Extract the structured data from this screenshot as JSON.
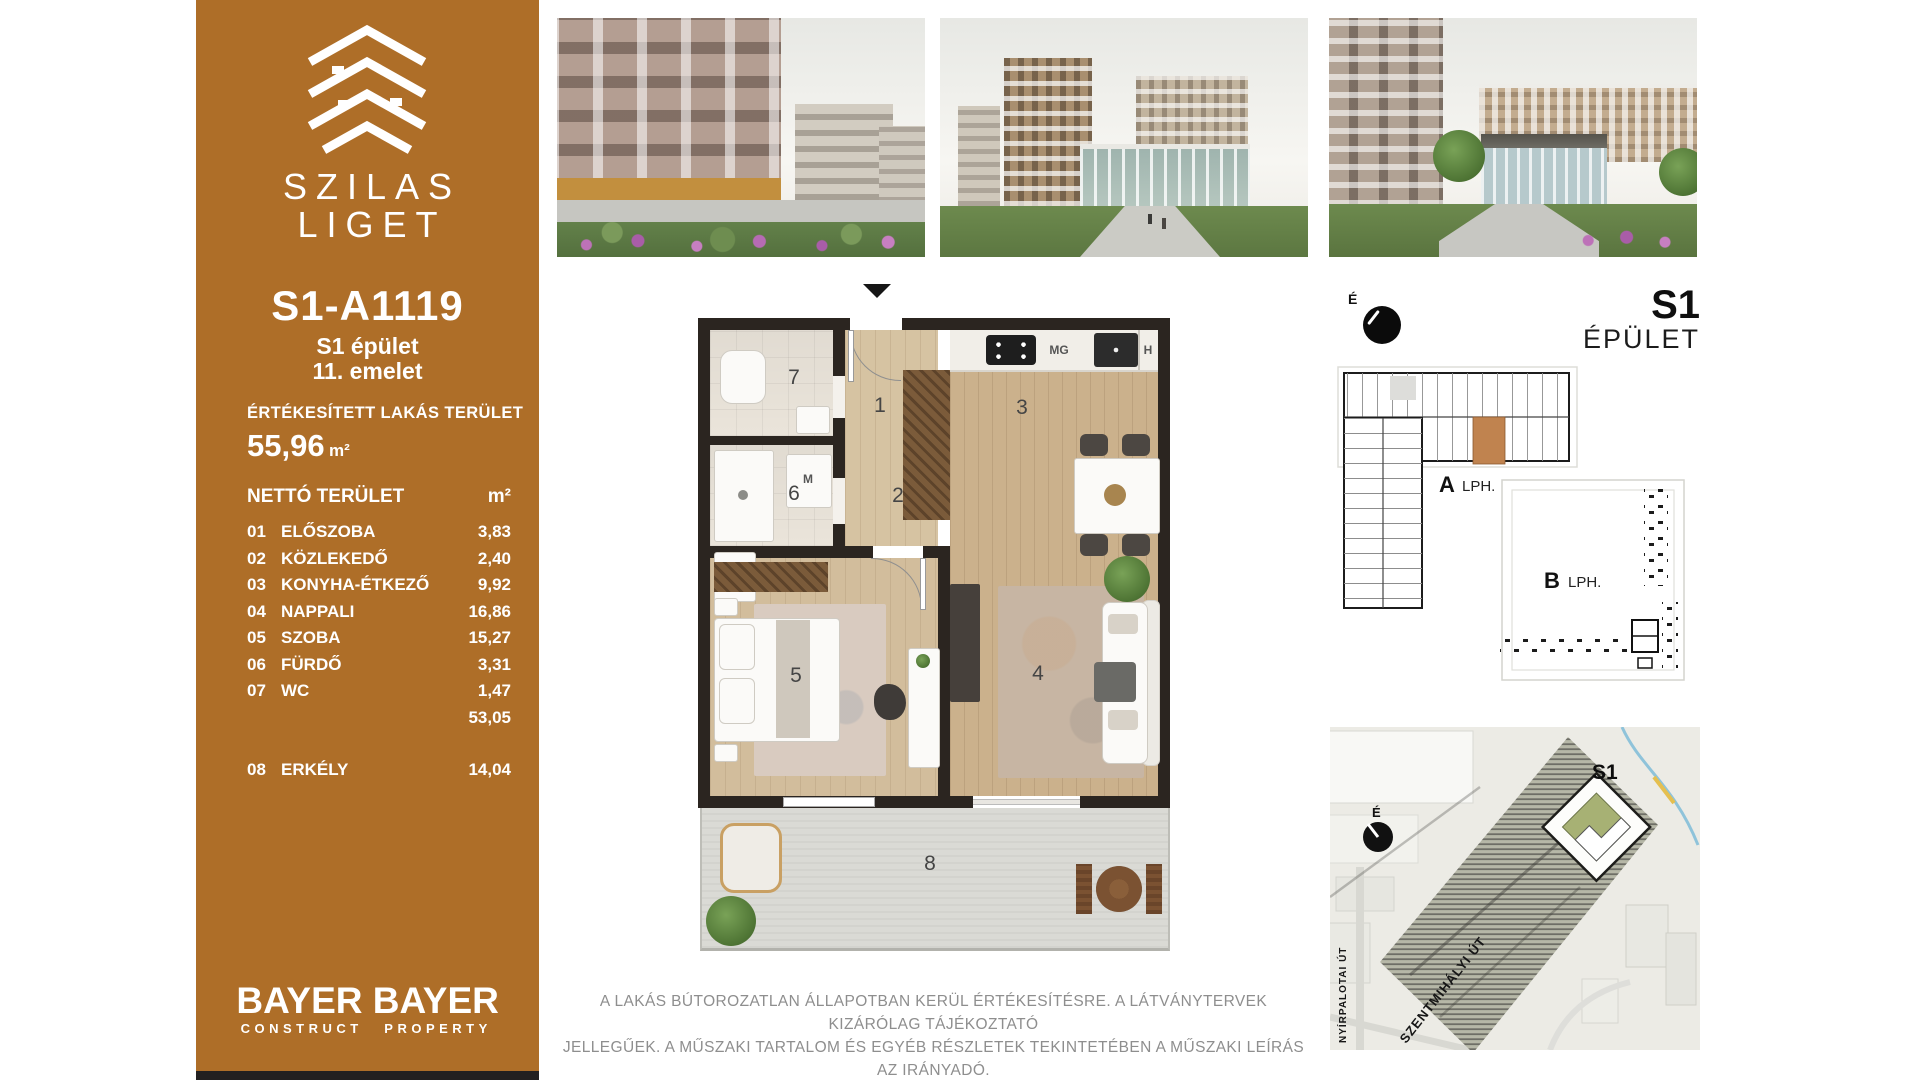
{
  "sidebar": {
    "brand_top": "SZILAS",
    "brand_bottom": "LIGET",
    "unit_id": "S1-A1119",
    "building_line": "S1 épület",
    "floor_line": "11. emelet",
    "sold_area_label": "ÉRTÉKESÍTETT LAKÁS TERÜLET",
    "sold_area_value": "55,96",
    "sold_area_unit": "m²",
    "net_area_label": "NETTÓ TERÜLET",
    "net_area_unit": "m²",
    "rooms": [
      {
        "num": "01",
        "name": "ELŐSZOBA",
        "area": "3,83"
      },
      {
        "num": "02",
        "name": "KÖZLEKEDŐ",
        "area": "2,40"
      },
      {
        "num": "03",
        "name": "KONYHA-ÉTKEZŐ",
        "area": "9,92"
      },
      {
        "num": "04",
        "name": "NAPPALI",
        "area": "16,86"
      },
      {
        "num": "05",
        "name": "SZOBA",
        "area": "15,27"
      },
      {
        "num": "06",
        "name": "FÜRDŐ",
        "area": "3,31"
      },
      {
        "num": "07",
        "name": "WC",
        "area": "1,47"
      },
      {
        "num": "",
        "name": "",
        "area": "53,05"
      },
      {
        "num": "08",
        "name": "ERKÉLY",
        "area": "14,04"
      }
    ],
    "logo_construct": {
      "line1": "BAYER",
      "line2": "CONSTRUCT"
    },
    "logo_property": {
      "line1": "BAYER",
      "line2": "PROPERTY"
    }
  },
  "floorplan": {
    "numbers": {
      "hall": "1",
      "corridor": "2",
      "kitchen": "3",
      "living": "4",
      "bedroom": "5",
      "bath": "6",
      "wc": "7",
      "terrace": "8"
    },
    "appliances": {
      "hob": "MG",
      "fridge": "H",
      "washer": "M"
    }
  },
  "key_plan": {
    "north_label": "É",
    "building_title": "S1",
    "building_subtitle": "ÉPÜLET",
    "stair_a": "A",
    "stair_a_text": "LPH.",
    "stair_b": "B",
    "stair_b_text": "LPH."
  },
  "site_map": {
    "north_label": "É",
    "building_label": "S1",
    "street_diagonal": "SZENTMIHÁLYI ÚT",
    "street_vertical": "NYÍRPALOTAI ÚT"
  },
  "disclaimer": {
    "line1": "A LAKÁS BÚTOROZATLAN ÁLLAPOTBAN KERÜL ÉRTÉKESÍTÉSRE. A LÁTVÁNYTERVEK KIZÁRÓLAG TÁJÉKOZTATÓ",
    "line2": "JELLEGŰEK. A MŰSZAKI TARTALOM ÉS EGYÉB RÉSZLETEK TEKINTETÉBEN A MŰSZAKI LEÍRÁS AZ IRÁNYADÓ."
  },
  "colors": {
    "sidebar_brown": "#ae6e28",
    "footer_black": "#232020",
    "highlight_orange": "#c0834f",
    "wall_dark": "#2b2520",
    "disclaimer_gray": "#8e8e8e"
  }
}
